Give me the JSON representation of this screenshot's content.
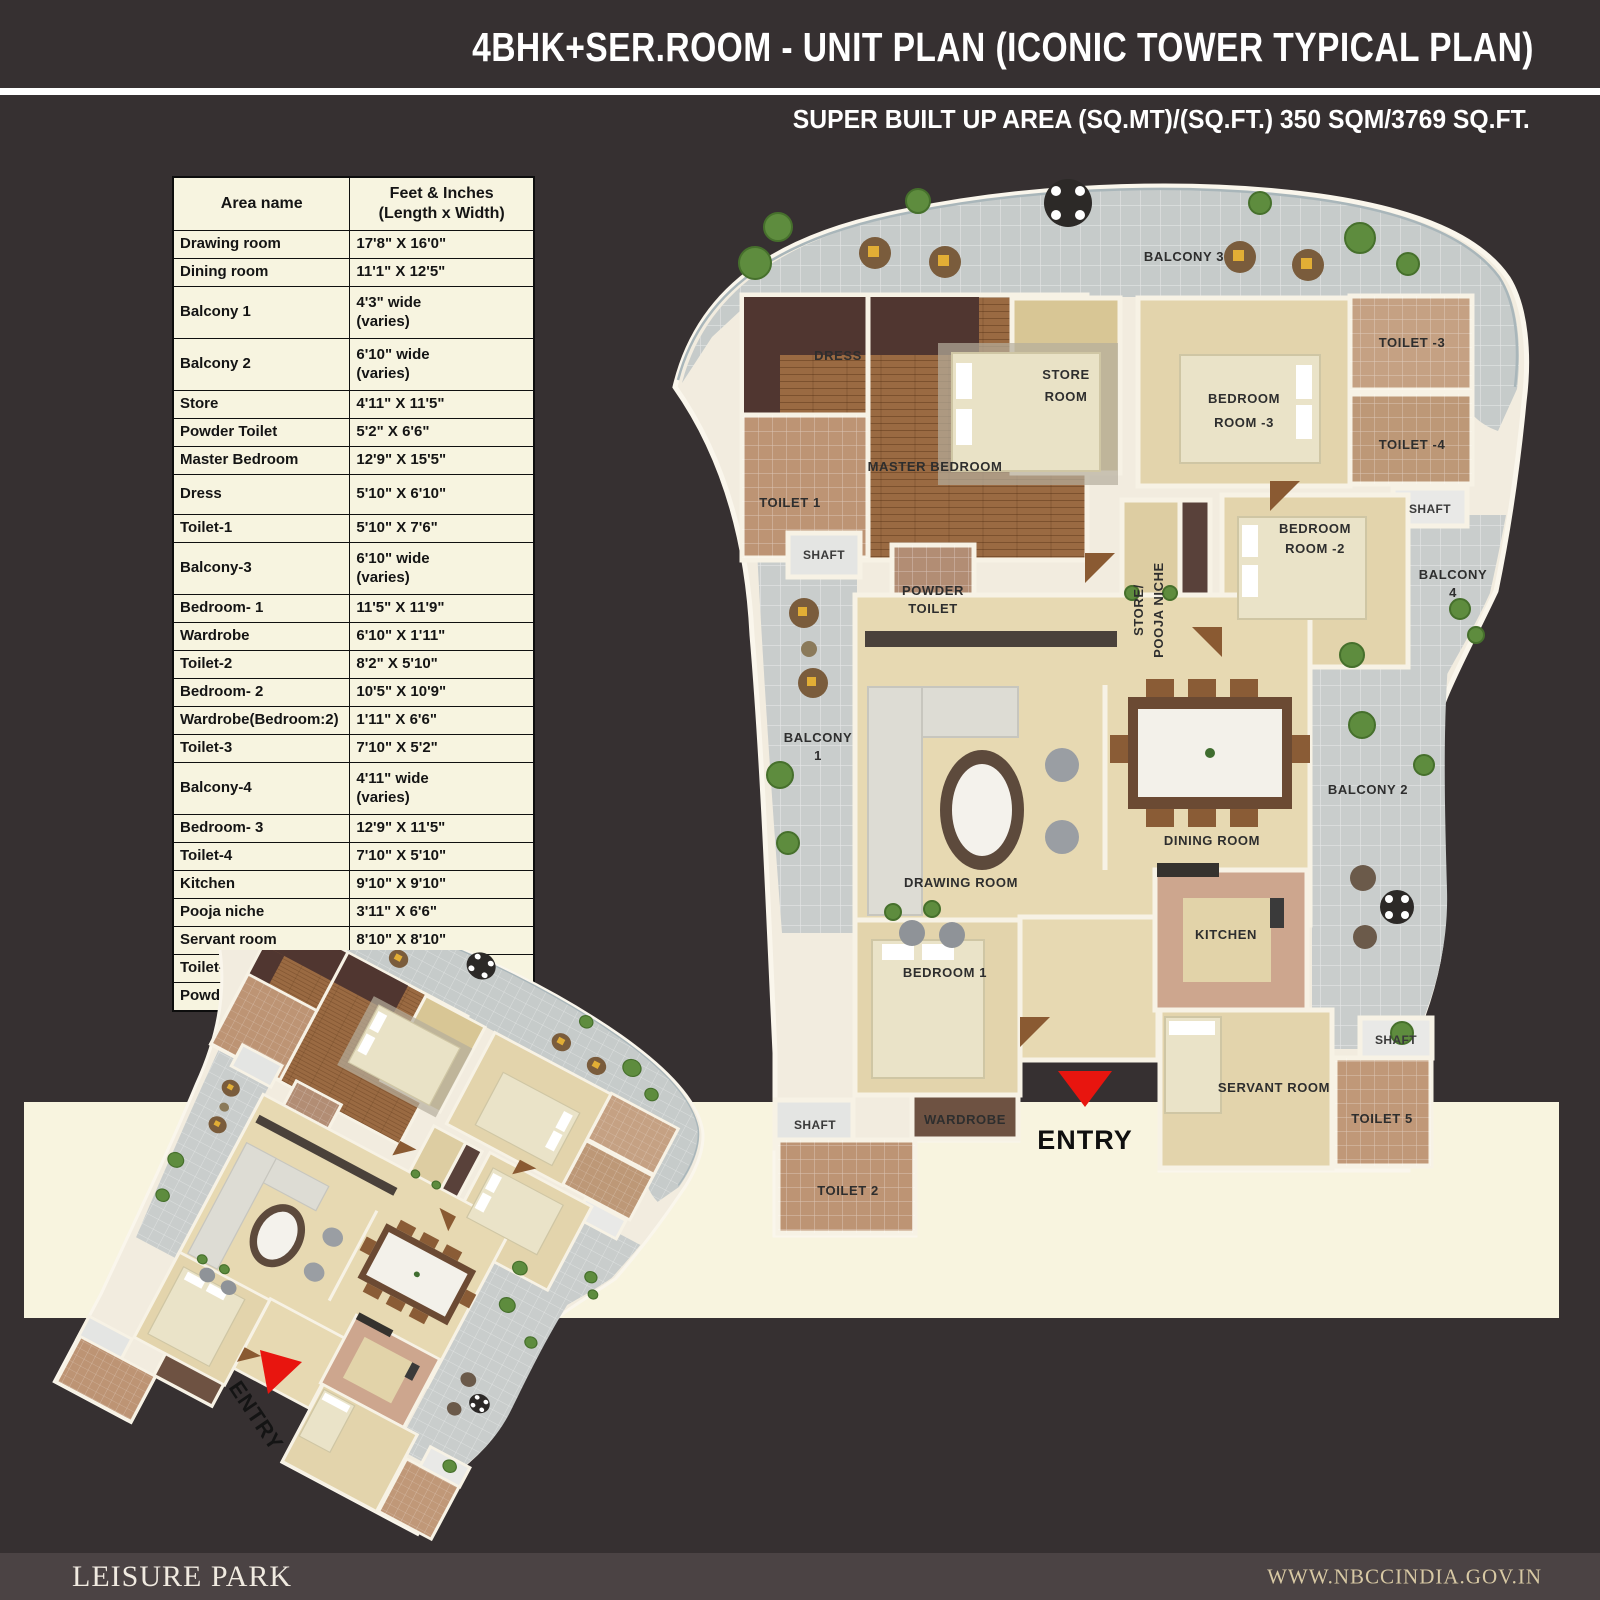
{
  "header": {
    "title": "4BHK+SER.ROOM - UNIT PLAN (ICONIC TOWER TYPICAL PLAN)",
    "subtitle": "SUPER BUILT UP AREA (SQ.MT)/(SQ.FT.) 350 SQM/3769 SQ.FT."
  },
  "table": {
    "col1_header": "Area name",
    "col2_header": "Feet & Inches\n(Length x Width)",
    "rows": [
      {
        "name": "Drawing room",
        "size": "17'8\" X 16'0\""
      },
      {
        "name": "Dining room",
        "size": "11'1\" X 12'5\""
      },
      {
        "name": "Balcony 1",
        "size": "4'3\" wide\n(varies)"
      },
      {
        "name": "Balcony 2",
        "size": "6'10\" wide\n(varies)"
      },
      {
        "name": "Store",
        "size": "4'11\" X 11'5\""
      },
      {
        "name": "Powder Toilet",
        "size": "5'2\" X 6'6\""
      },
      {
        "name": "Master Bedroom",
        "size": "12'9\" X 15'5\""
      },
      {
        "name": "Dress",
        "size": "5'10\" X 6'10\""
      },
      {
        "name": "Toilet-1",
        "size": "5'10\" X 7'6\""
      },
      {
        "name": "Balcony-3",
        "size": "6'10\" wide\n(varies)"
      },
      {
        "name": "Bedroom- 1",
        "size": "11'5\" X 11'9\""
      },
      {
        "name": "Wardrobe",
        "size": "6'10\" X 1'11\""
      },
      {
        "name": "Toilet-2",
        "size": "8'2\" X 5'10\""
      },
      {
        "name": "Bedroom- 2",
        "size": "10'5\" X 10'9\""
      },
      {
        "name": "Wardrobe(Bedroom:2)",
        "size": "1'11\" X 6'6\""
      },
      {
        "name": "Toilet-3",
        "size": "7'10\" X 5'2\""
      },
      {
        "name": "Balcony-4",
        "size": "4'11\" wide\n(varies)"
      },
      {
        "name": "Bedroom- 3",
        "size": "12'9\" X 11'5\""
      },
      {
        "name": "Toilet-4",
        "size": "7'10\" X 5'10\""
      },
      {
        "name": "Kitchen",
        "size": "9'10\" X 9'10\""
      },
      {
        "name": "Pooja niche",
        "size": "3'11\" X 6'6\""
      },
      {
        "name": "Servant room",
        "size": "8'10\" X 8'10\""
      },
      {
        "name": "Toilet-5",
        "size": "4'11\" X 5'10\""
      },
      {
        "name": "Powder Toilet",
        "size": "5'2\" X 6'6\""
      }
    ]
  },
  "plan": {
    "labels": {
      "balcony3": "BALCONY 3",
      "dress": "DRESS",
      "master_bedroom": "MASTER BEDROOM",
      "store_line1": "STORE",
      "store_line2": "ROOM",
      "bedroom3_line1": "BEDROOM",
      "bedroom3_line2": "ROOM -3",
      "toilet3": "TOILET -3",
      "toilet4": "TOILET -4",
      "shaft_right": "SHAFT",
      "toilet1": "TOILET 1",
      "shaft_left": "SHAFT",
      "powder_line1": "POWDER",
      "powder_line2": "TOILET",
      "bedroom2_line1": "BEDROOM",
      "bedroom2_line2": "ROOM -2",
      "balcony4_line1": "BALCONY",
      "balcony4_line2": "4",
      "pooja_line1": "STORE/",
      "pooja_line2": "POOJA NICHE",
      "balcony1_line1": "BALCONY",
      "balcony1_line2": "1",
      "dining_room": "DINING ROOM",
      "balcony2": "BALCONY 2",
      "drawing_room": "DRAWING ROOM",
      "kitchen": "KITCHEN",
      "bedroom1": "BEDROOM 1",
      "shaft_bottom_right": "SHAFT",
      "servant_room": "SERVANT ROOM",
      "wardrobe": "WARDROBE",
      "toilet5": "TOILET 5",
      "shaft_bottom_left": "SHAFT",
      "toilet2": "TOILET 2"
    },
    "entry": "ENTRY"
  },
  "iso": {
    "entry": "ENTRY"
  },
  "footer": {
    "brand": "LEISURE PARK",
    "website": "WWW.NBCCINDIA.GOV.IN"
  }
}
